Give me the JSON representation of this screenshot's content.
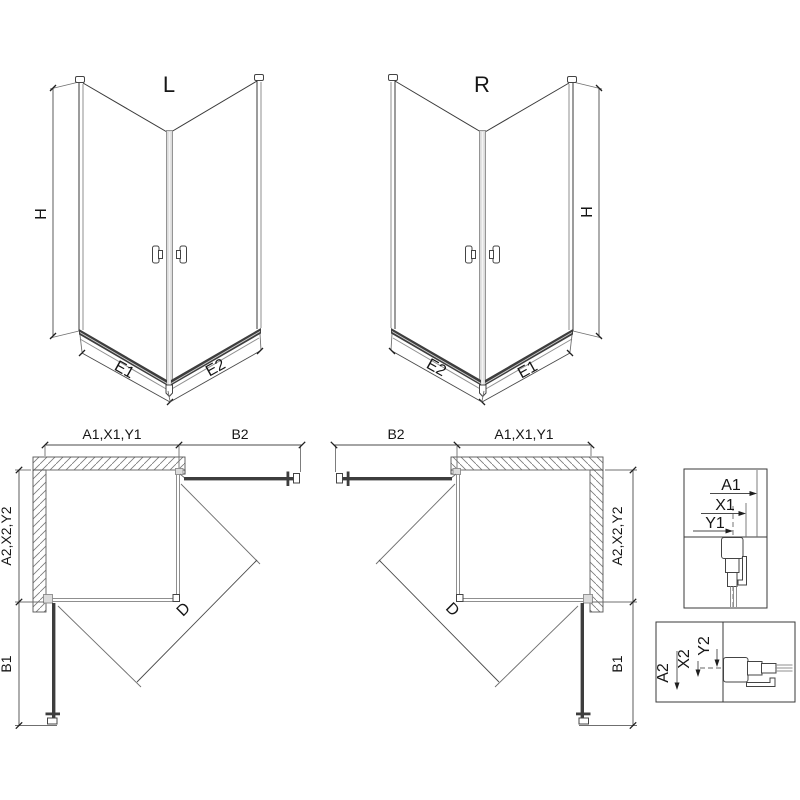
{
  "drawing": {
    "iso_left": {
      "label": "L",
      "height_label": "H",
      "bottom_left_label": "E1",
      "bottom_right_label": "E2"
    },
    "iso_right": {
      "label": "R",
      "height_label": "H",
      "bottom_left_label": "E2",
      "bottom_right_label": "E1"
    },
    "plan_left": {
      "top_left_label": "A1,X1,Y1",
      "top_right_label": "B2",
      "left_upper_label": "A2,X2,Y2",
      "left_lower_label": "B1",
      "diagonal_label": "D"
    },
    "plan_right": {
      "top_left_label": "B2",
      "top_right_label": "A1,X1,Y1",
      "right_upper_label": "A2,X2,Y2",
      "right_lower_label": "B1",
      "diagonal_label": "D"
    },
    "detail_width": {
      "a_label": "A1",
      "x_label": "X1",
      "y_label": "Y1"
    },
    "detail_depth": {
      "a_label": "A2",
      "x_label": "X2",
      "y_label": "Y2"
    },
    "colors": {
      "line": "#3a3a3a",
      "glass": "#8f8f8f",
      "rail": "#3d3d3d",
      "profile_fill": "#dcdcdc"
    }
  }
}
